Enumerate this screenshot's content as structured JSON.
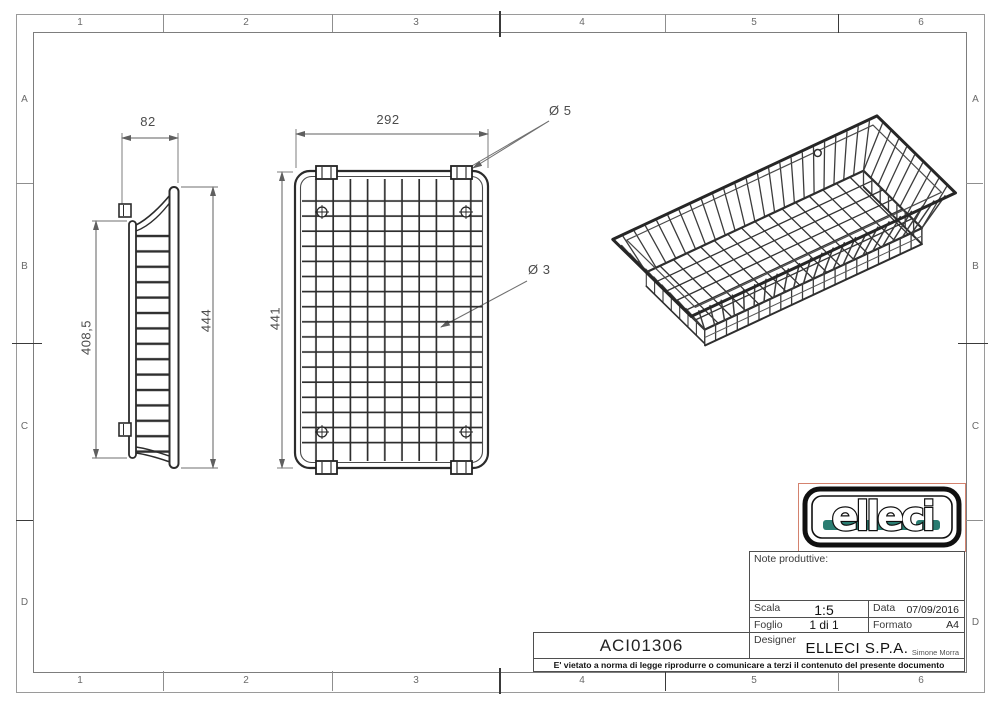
{
  "sheet": {
    "frame": {
      "top_labels": [
        "1",
        "2",
        "3",
        "4",
        "5",
        "6"
      ],
      "bottom_labels": [
        "1",
        "2",
        "3",
        "4",
        "5",
        "6"
      ],
      "left_labels": [
        "A",
        "B",
        "C",
        "D"
      ],
      "right_labels": [
        "A",
        "B",
        "C",
        "D"
      ]
    },
    "views": {
      "side": {
        "width": "82",
        "inner_height": "408,5",
        "outer_height": "444"
      },
      "plan": {
        "width": "292",
        "height": "441",
        "rim_wire_dia": "Ø 5",
        "mesh_wire_dia": "Ø 3"
      }
    },
    "title_block": {
      "notes_label": "Note produttive:",
      "scala_label": "Scala",
      "scala_value": "1:5",
      "data_label": "Data",
      "data_value": "07/09/2016",
      "foglio_label": "Foglio",
      "foglio_value": "1 di 1",
      "formato_label": "Formato",
      "formato_value": "A4",
      "designer_label": "Designer",
      "company": "ELLECI S.P.A.",
      "designer_name": "Simone Morra",
      "part_code": "ACI01306",
      "disclaimer": "E' vietato a norma di legge riprodurre o comunicare a terzi il contenuto del presente documento"
    },
    "logo": {
      "text": "elleci",
      "accent_color": "#2a7d72"
    }
  }
}
